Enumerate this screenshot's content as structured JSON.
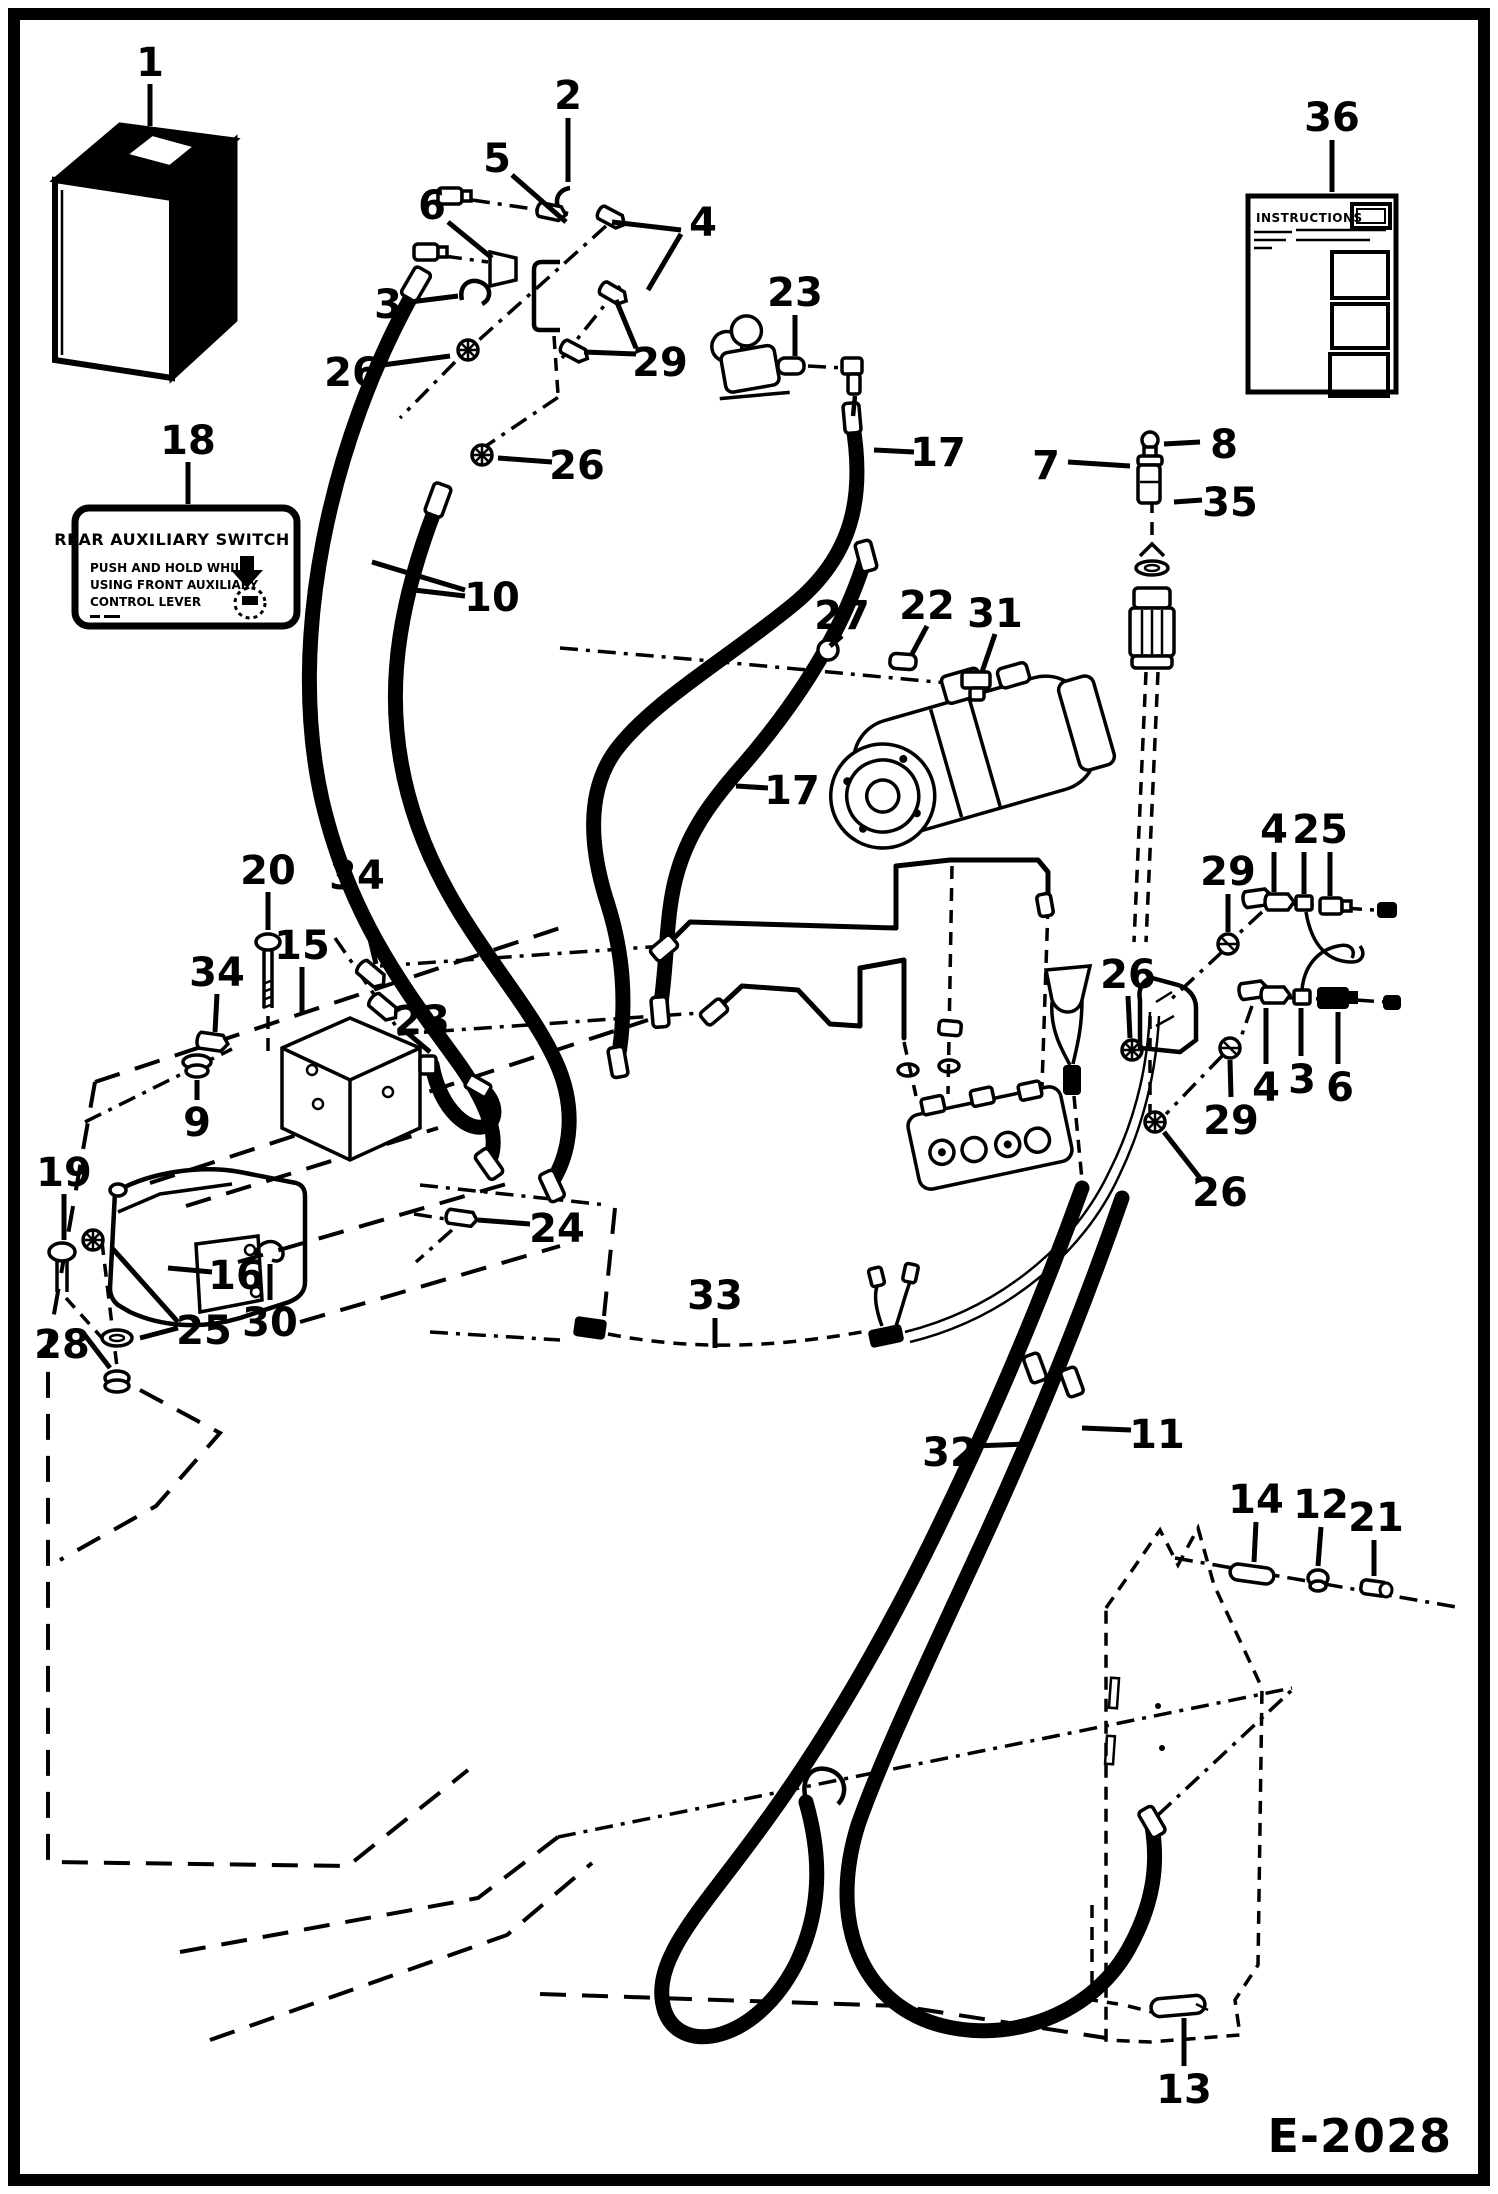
{
  "page": {
    "drawing_number": "E-2028"
  },
  "decals": {
    "rear_aux_switch": {
      "title": "REAR AUXILIARY SWITCH",
      "line1": "PUSH AND HOLD WHILE",
      "line2": "USING FRONT AUXILIARY",
      "line3": "CONTROL LEVER"
    },
    "instructions": {
      "title": "INSTRUCTIONS"
    }
  },
  "callouts": [
    {
      "t": "1"
    },
    {
      "t": "2"
    },
    {
      "t": "5"
    },
    {
      "t": "6"
    },
    {
      "t": "3"
    },
    {
      "t": "4"
    },
    {
      "t": "29"
    },
    {
      "t": "26"
    },
    {
      "t": "23"
    },
    {
      "t": "17"
    },
    {
      "t": "7"
    },
    {
      "t": "8"
    },
    {
      "t": "35"
    },
    {
      "t": "36"
    },
    {
      "t": "18"
    },
    {
      "t": "10"
    },
    {
      "t": "26"
    },
    {
      "t": "27"
    },
    {
      "t": "22"
    },
    {
      "t": "31"
    },
    {
      "t": "17"
    },
    {
      "t": "20"
    },
    {
      "t": "34"
    },
    {
      "t": "34"
    },
    {
      "t": "15"
    },
    {
      "t": "23"
    },
    {
      "t": "9"
    },
    {
      "t": "19"
    },
    {
      "t": "16"
    },
    {
      "t": "30"
    },
    {
      "t": "28"
    },
    {
      "t": "25"
    },
    {
      "t": "24"
    },
    {
      "t": "33"
    },
    {
      "t": "4"
    },
    {
      "t": "2"
    },
    {
      "t": "5"
    },
    {
      "t": "29"
    },
    {
      "t": "26"
    },
    {
      "t": "4"
    },
    {
      "t": "3"
    },
    {
      "t": "6"
    },
    {
      "t": "29"
    },
    {
      "t": "26"
    },
    {
      "t": "32"
    },
    {
      "t": "11"
    },
    {
      "t": "14"
    },
    {
      "t": "12"
    },
    {
      "t": "21"
    },
    {
      "t": "13"
    }
  ]
}
